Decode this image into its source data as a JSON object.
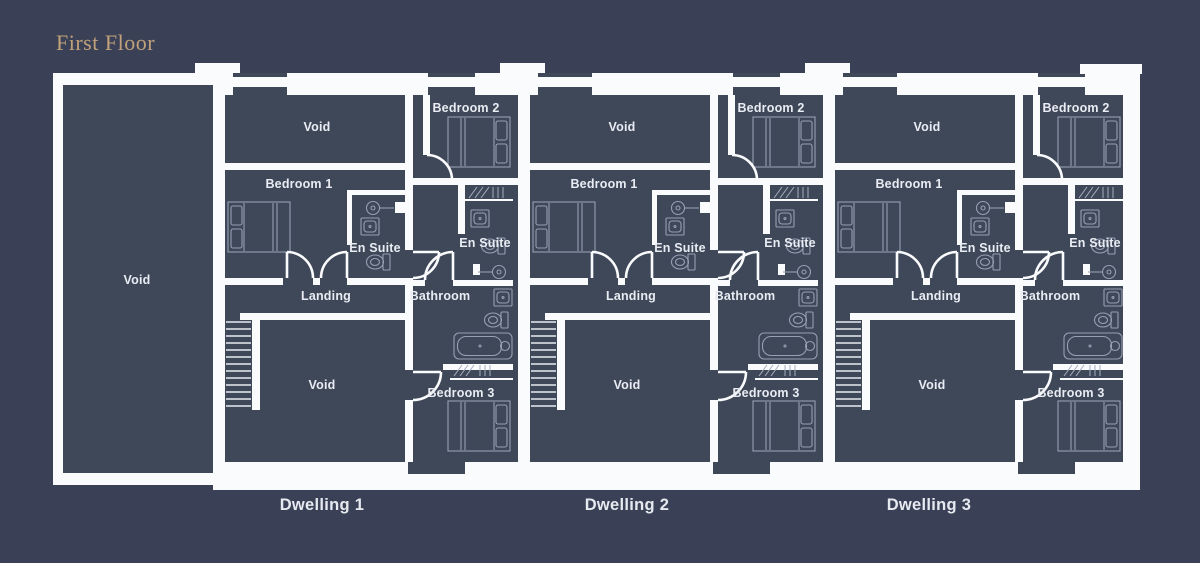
{
  "page": {
    "title": "First Floor",
    "background": "#3a4156"
  },
  "palette": {
    "wall": "#fafbfd",
    "room_fill": "#3f4859",
    "furniture_line": "#97a0b3",
    "label_text": "#e9ecf2",
    "title_text": "#c2a27b"
  },
  "left_wing": {
    "label": "Void"
  },
  "dwelling_template": {
    "rooms": {
      "void_top": "Void",
      "bedroom1": "Bedroom 1",
      "ensuite1": "En Suite",
      "bedroom2": "Bedroom 2",
      "ensuite2": "En Suite",
      "landing": "Landing",
      "bathroom": "Bathroom",
      "void_bottom": "Void",
      "bedroom3": "Bedroom 3"
    }
  },
  "dwellings": [
    {
      "caption": "Dwelling 1"
    },
    {
      "caption": "Dwelling 2"
    },
    {
      "caption": "Dwelling 3"
    }
  ]
}
